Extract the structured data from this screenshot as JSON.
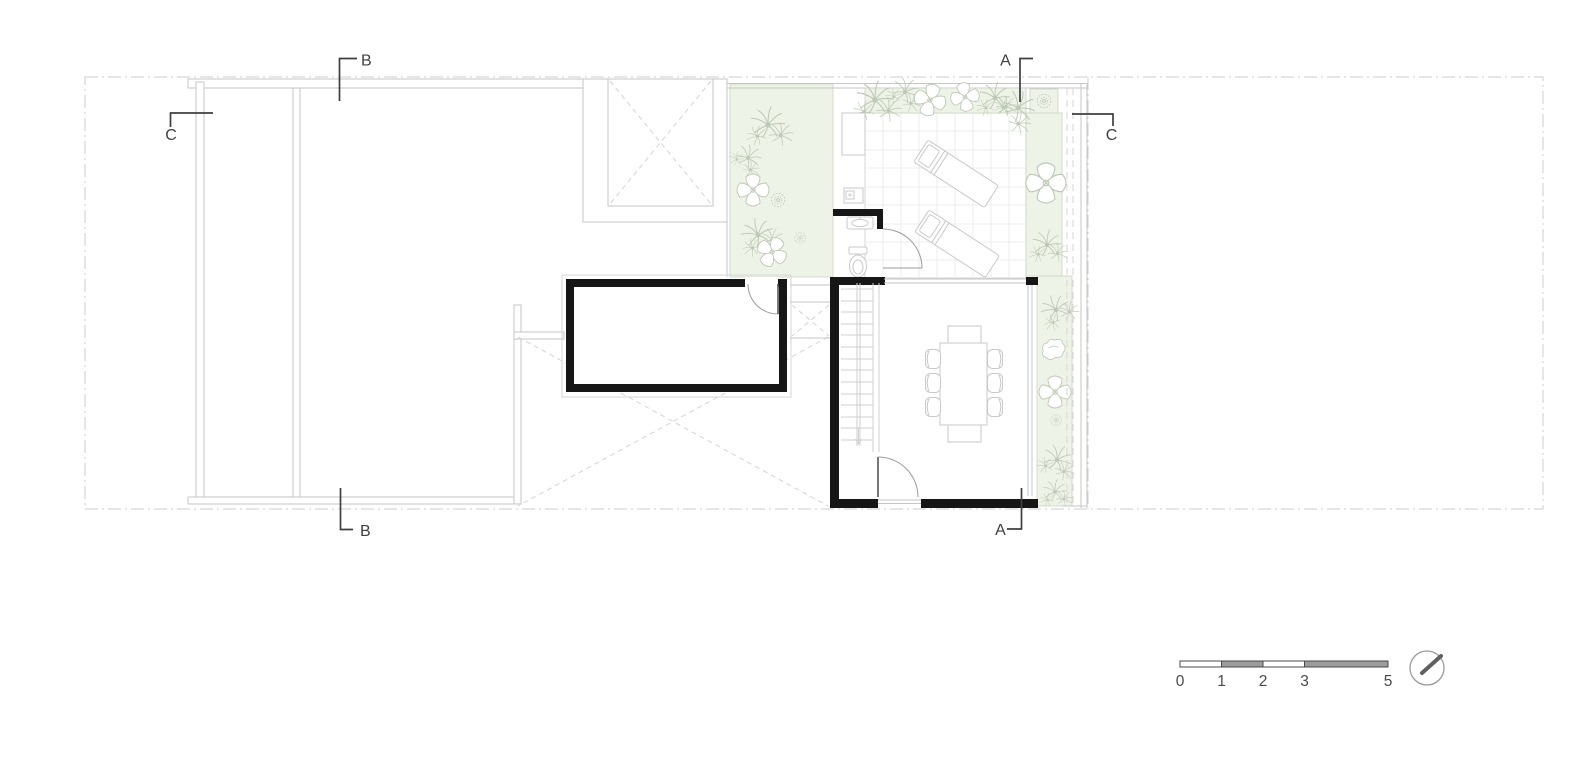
{
  "plan": {
    "section_markers": {
      "b_top": "B",
      "c_left": "C",
      "a_top": "A",
      "c_right": "C",
      "b_bottom": "B",
      "a_bottom": "A"
    },
    "scale_bar": {
      "labels": [
        "0",
        "1",
        "2",
        "3",
        "5"
      ]
    },
    "icons": {
      "north_arrow": "north-arrow-compass"
    },
    "colors": {
      "background": "#ffffff",
      "wall_black": "#161616",
      "line_gray": "#c6c6c6",
      "boundary_dashdot": "#cdcdcd",
      "marker_dark": "#3f3f3f",
      "planting_fill": "#eef3e7",
      "plant_stroke": "#bdc7b6",
      "tile_line": "#e9e9e9",
      "scale_gray": "#9c9c9c"
    }
  }
}
